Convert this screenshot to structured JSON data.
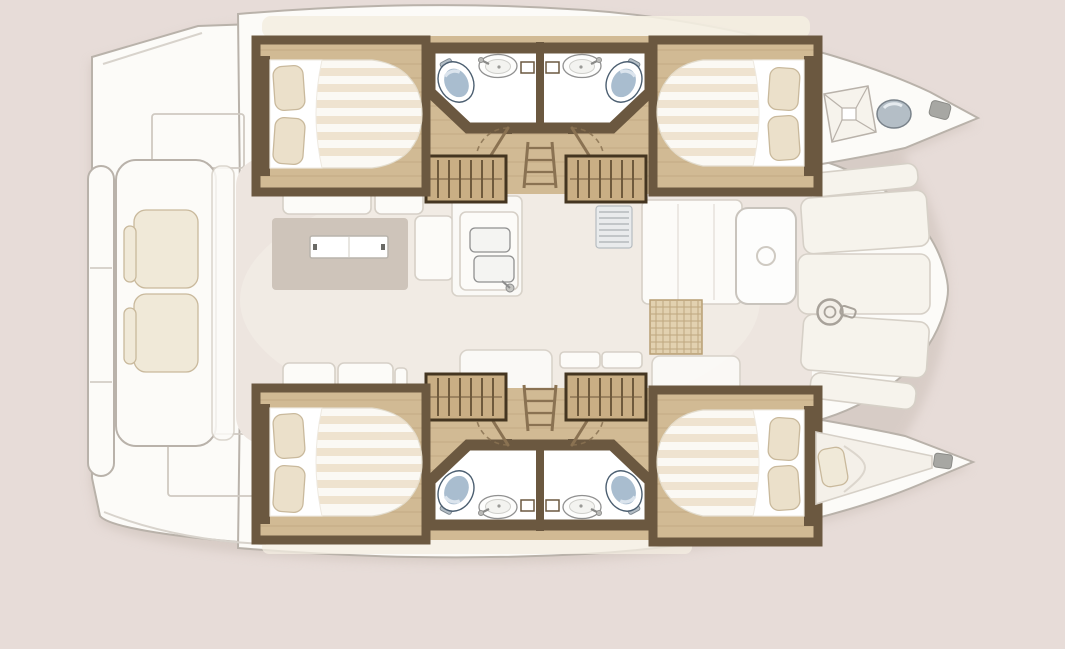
{
  "meta": {
    "description": "Top-down interior floor plan of a sailing catamaran, bow pointing right: four double cabins and four bathrooms in the two hulls, central salon with dinette table, galley double sink and cabinets, companionway stairs into each hull, aft cockpit bench with cushions, swim-platform steps, foredeck panels with windlass winch, bow hatch and forepeak berth.",
    "type": "boat-floorplan",
    "vessel": "catamaran",
    "orientation": "bow-right"
  },
  "palette": {
    "bg": "#e7dcd8",
    "shadow": "#c9bdb5",
    "hull": "#fcfbf8",
    "hullLine": "#b9b2aa",
    "panel": "#f6f3ec",
    "panelLine": "#d6d0c7",
    "ivory": "#f4eee1",
    "floor": "#ede5df",
    "floorHi": "#f7f1eb",
    "rug": "#cec4ba",
    "wood": "#d1ba94",
    "plank": "#aa8f66",
    "wall": "#6b5840",
    "wallDark": "#443520",
    "stair": "#c9ae84",
    "stairLine": "#6f5a3c",
    "mattress": "#fbf9f4",
    "mattEdge": "#e2dccd",
    "stripe": "#eadbc0",
    "white": "#ffffff",
    "pillow": "#ebe0ca",
    "pillowLine": "#c9b99c",
    "cushion": "#f0e9d8",
    "toilet": "#a9bdcf",
    "toiletHi": "#dde6ee",
    "toiletLine": "#4c5f71",
    "fixtureLine": "#909090",
    "grid": "#e2d1b0",
    "gridLine": "#b79e73",
    "metal": "#b4bec6",
    "metalLine": "#7e8890",
    "arc": "#8a7252",
    "seam": "#d8d3cc",
    "deckLine": "#cfc9c1"
  },
  "features": {
    "hulls": [
      {
        "name": "port-hull",
        "position": "top"
      },
      {
        "name": "starboard-hull",
        "position": "bottom"
      }
    ],
    "cabins": [
      {
        "name": "port-aft-cabin",
        "berth": "double",
        "pillows": 2
      },
      {
        "name": "port-forward-cabin",
        "berth": "double",
        "pillows": 2
      },
      {
        "name": "starboard-aft-cabin",
        "berth": "double",
        "pillows": 2
      },
      {
        "name": "starboard-forward-cabin",
        "berth": "double",
        "pillows": 2
      },
      {
        "name": "forepeak-berth",
        "berth": "single",
        "pillows": 1
      }
    ],
    "bathrooms": [
      {
        "name": "port-aft-bathroom",
        "fixtures": [
          "toilet",
          "washbasin",
          "door"
        ]
      },
      {
        "name": "port-forward-bathroom",
        "fixtures": [
          "toilet",
          "washbasin",
          "door"
        ]
      },
      {
        "name": "starboard-aft-bathroom",
        "fixtures": [
          "toilet",
          "washbasin",
          "door"
        ]
      },
      {
        "name": "starboard-forward-bathroom",
        "fixtures": [
          "toilet",
          "washbasin",
          "door"
        ]
      }
    ],
    "salon": {
      "items": [
        "dinette-table",
        "rug",
        "sofa-cushions",
        "galley-double-sink",
        "faucet",
        "vent-louver",
        "galley-cabinets",
        "door-with-porthole",
        "floor-hatch-grid"
      ]
    },
    "stairs": {
      "companionway-steps": 4,
      "ladders": 2
    },
    "cockpit": {
      "items": [
        "bench-seat",
        "seat-cushions",
        "swim-platform-steps",
        "deck-hatch",
        "transom-deck-hatch"
      ]
    },
    "foredeck": {
      "items": [
        "deck-panels",
        "windlass-winch",
        "bow-hatch",
        "bow-portlight",
        "bow-cleat"
      ]
    }
  }
}
